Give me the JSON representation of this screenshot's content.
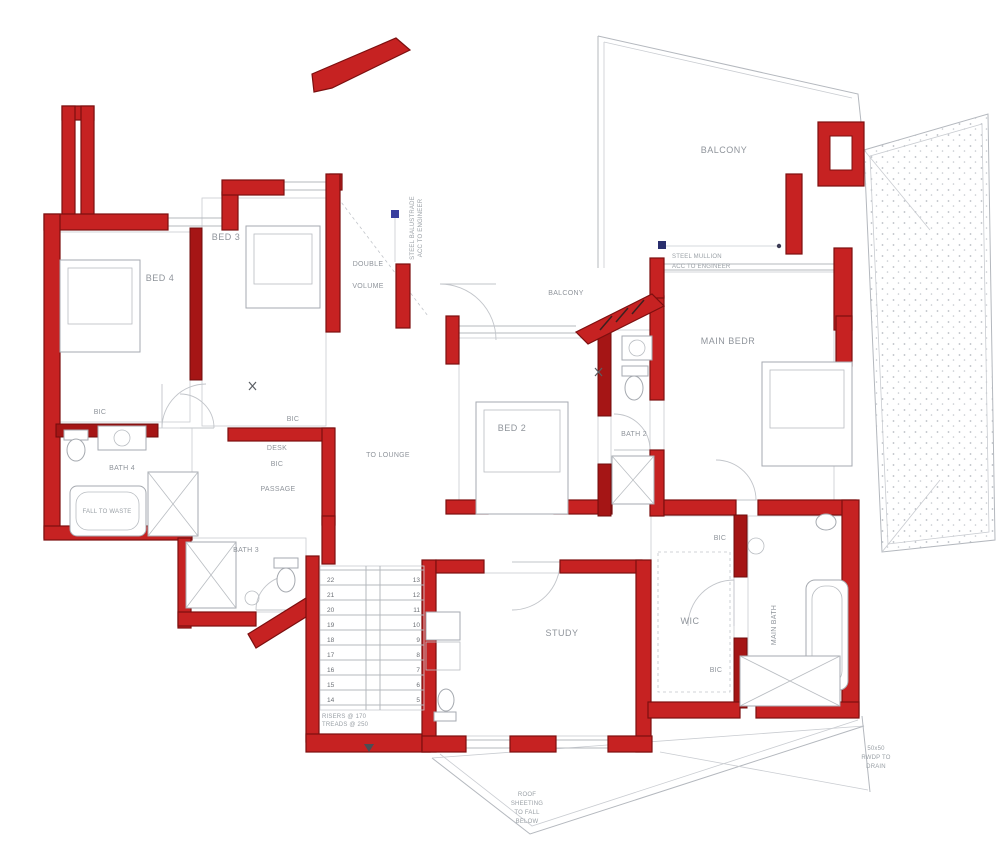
{
  "title": "First Floor Plan",
  "colors": {
    "wall_red": "#c62222",
    "wall_dark": "#7c0f0f",
    "line_gray": "#b4b8be",
    "text_gray": "#8f949b",
    "marker_blue": "#3a3f9e"
  },
  "rooms": {
    "bed4": "BED 4",
    "bed3": "BED 3",
    "bed2": "BED 2",
    "main_bed": "MAIN BEDR",
    "study": "STUDY",
    "wic": "WIC",
    "main_bath": "MAIN BATH",
    "bath2": "BATH 2",
    "bath3": "BATH 3",
    "bath4": "BATH 4",
    "balcony_top": "BALCONY",
    "balcony_mid": "BALCONY",
    "passage": "PASSAGE",
    "double_volume_line1": "DOUBLE",
    "double_volume_line2": "VOLUME",
    "to_lounge": "TO LOUNGE",
    "desk": "DESK"
  },
  "bic": {
    "bed4": "BIC",
    "bed3": "BIC",
    "passage": "BIC",
    "wic_top": "BIC",
    "wic_bottom": "BIC"
  },
  "notes": {
    "balustrade_line1": "STEEL BALUSTRADE",
    "balustrade_line2": "ACC TO ENGINEER",
    "mullion_line1": "STEEL MULLION",
    "mullion_line2": "ACC TO ENGINEER",
    "tub_note": "FALL TO WASTE",
    "stair_note_line1": "RISERS @ 170",
    "stair_note_line2": "TREADS @ 250",
    "bottom_note_line1": "ROOF",
    "bottom_note_line2": "SHEETING",
    "bottom_note_line3": "TO FALL",
    "bottom_note_line4": "BELOW",
    "corner_note_line1": "50x50",
    "corner_note_line2": "RWDP TO",
    "corner_note_line3": "DRAIN"
  },
  "stairs": {
    "left": [
      "22",
      "21",
      "20",
      "19",
      "18",
      "17",
      "16",
      "15",
      "14"
    ],
    "right": [
      "13",
      "12",
      "11",
      "10",
      "9",
      "8",
      "7",
      "6",
      "5"
    ]
  }
}
